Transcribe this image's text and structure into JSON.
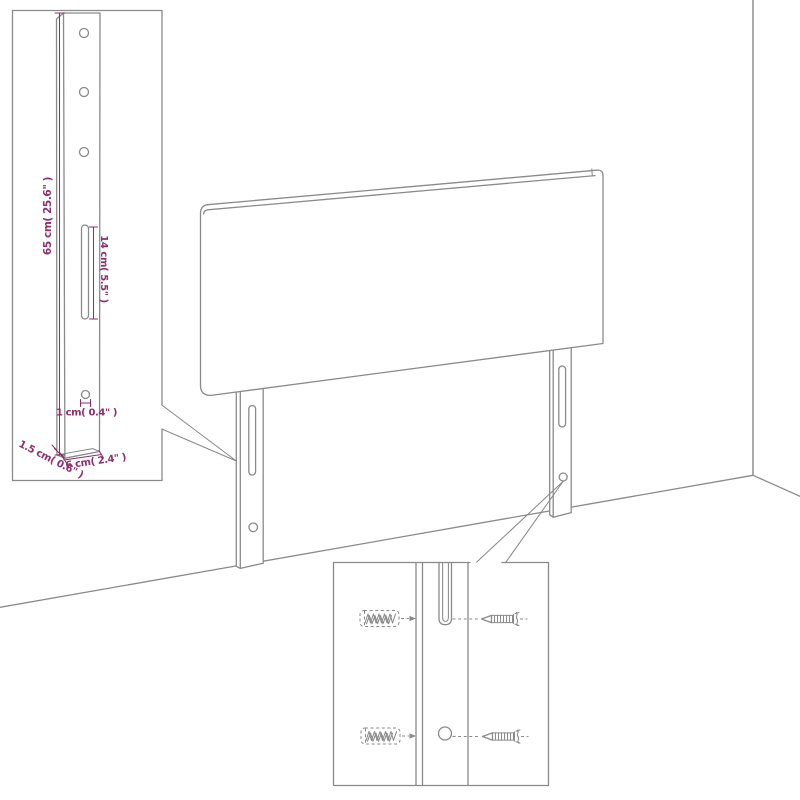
{
  "colors": {
    "line": "#8a8a8a",
    "dimension": "#8b2f6e",
    "background": "#ffffff"
  },
  "dimensions": {
    "leg_height": "65 cm( 25.6\" )",
    "slot_length": "14 cm( 5.5\" )",
    "hole_diameter": "1 cm( 0.4\" )",
    "leg_thickness": "1.5 cm( 0.6\" )",
    "leg_width": "6 cm( 2.4\" )"
  },
  "icons": {
    "wall_plug": "wall-plug-icon",
    "screw": "screw-icon"
  }
}
